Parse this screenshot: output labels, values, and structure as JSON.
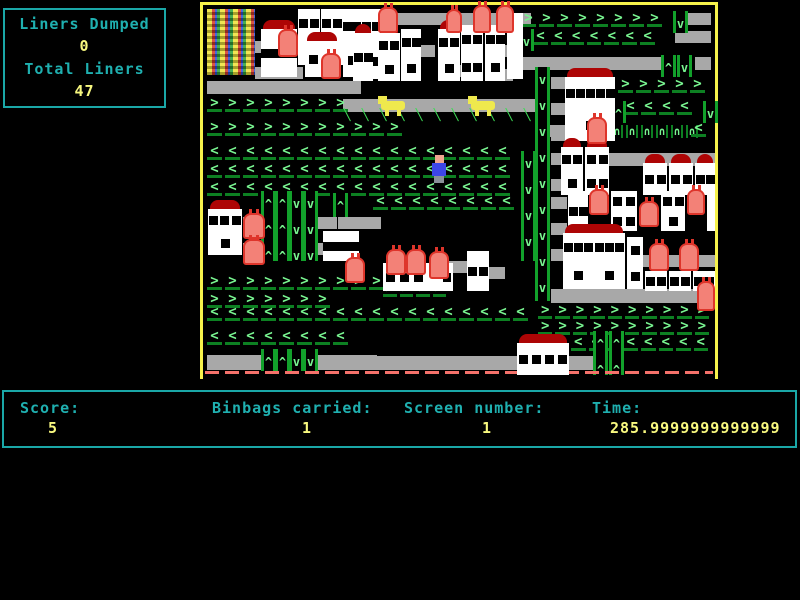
{
  "hud": {
    "liners_dumped_label": "Liners Dumped",
    "liners_dumped_value": "0",
    "total_liners_label": "Total Liners",
    "total_liners_value": "47"
  },
  "status": {
    "score_label": "Score:",
    "score_value": "5",
    "binbags_label": "Binbags carried:",
    "binbags_value": "1",
    "screen_label": "Screen number:",
    "screen_value": "1",
    "time_label": "Time:",
    "time_value": "285.9999999999999"
  },
  "palette": {
    "hud_border": "#1aa7a7",
    "label_teal": "#1fb0b0",
    "value_yellow": "#f8f87f",
    "field_border_yellow": "#f6f24b",
    "arrow_green": "#79f591",
    "bar_green": "#0d8022",
    "road_gray": "#a8a8a8",
    "roof_red": "#ad0505",
    "bin_salmon": "#f38177",
    "player_blue": "#3d46e8",
    "dog_yellow": "#efe94d"
  },
  "game": {
    "sprites": [
      {
        "t": "dump",
        "x": 4,
        "y": 4,
        "w": 48,
        "h": 66
      },
      {
        "t": "road",
        "x": 52,
        "y": 36,
        "w": 52,
        "h": 12
      },
      {
        "t": "road",
        "x": 52,
        "y": 62,
        "w": 48,
        "h": 12
      },
      {
        "t": "road",
        "x": 138,
        "y": 42,
        "w": 30,
        "h": 12
      },
      {
        "t": "road",
        "x": 148,
        "y": 8,
        "w": 180,
        "h": 12
      },
      {
        "t": "road",
        "x": 218,
        "y": 40,
        "w": 14,
        "h": 12
      },
      {
        "t": "road",
        "x": 250,
        "y": 60,
        "w": 14,
        "h": 12
      },
      {
        "t": "road",
        "x": 298,
        "y": 40,
        "w": 12,
        "h": 12
      },
      {
        "t": "road",
        "x": 298,
        "y": 64,
        "w": 12,
        "h": 12
      },
      {
        "t": "road",
        "x": 4,
        "y": 76,
        "w": 154,
        "h": 13
      },
      {
        "t": "road",
        "x": 140,
        "y": 94,
        "w": 200,
        "h": 13
      },
      {
        "t": "road",
        "x": 482,
        "y": 8,
        "w": 26,
        "h": 12
      },
      {
        "t": "road",
        "x": 472,
        "y": 26,
        "w": 36,
        "h": 12
      },
      {
        "t": "road",
        "x": 318,
        "y": 52,
        "w": 140,
        "h": 13
      },
      {
        "t": "road",
        "x": 492,
        "y": 52,
        "w": 16,
        "h": 13
      },
      {
        "t": "road",
        "x": 348,
        "y": 72,
        "w": 14,
        "h": 12
      },
      {
        "t": "road",
        "x": 348,
        "y": 98,
        "w": 14,
        "h": 12
      },
      {
        "t": "road",
        "x": 348,
        "y": 124,
        "w": 14,
        "h": 12
      },
      {
        "t": "road",
        "x": 340,
        "y": 120,
        "w": 44,
        "h": 12
      },
      {
        "t": "road",
        "x": 406,
        "y": 148,
        "w": 106,
        "h": 13
      },
      {
        "t": "road",
        "x": 348,
        "y": 148,
        "w": 12,
        "h": 12
      },
      {
        "t": "road",
        "x": 348,
        "y": 174,
        "w": 12,
        "h": 12
      },
      {
        "t": "road",
        "x": 40,
        "y": 212,
        "w": 18,
        "h": 12
      },
      {
        "t": "road",
        "x": 104,
        "y": 212,
        "w": 30,
        "h": 12
      },
      {
        "t": "road",
        "x": 40,
        "y": 238,
        "w": 18,
        "h": 12
      },
      {
        "t": "road",
        "x": 104,
        "y": 238,
        "w": 30,
        "h": 12
      },
      {
        "t": "road",
        "x": 135,
        "y": 212,
        "w": 43,
        "h": 12
      },
      {
        "t": "road",
        "x": 246,
        "y": 256,
        "w": 18,
        "h": 12
      },
      {
        "t": "road",
        "x": 286,
        "y": 262,
        "w": 16,
        "h": 12
      },
      {
        "t": "road",
        "x": 348,
        "y": 192,
        "w": 16,
        "h": 12
      },
      {
        "t": "road",
        "x": 348,
        "y": 218,
        "w": 16,
        "h": 12
      },
      {
        "t": "road",
        "x": 348,
        "y": 244,
        "w": 16,
        "h": 12
      },
      {
        "t": "road",
        "x": 440,
        "y": 250,
        "w": 72,
        "h": 12
      },
      {
        "t": "road",
        "x": 348,
        "y": 284,
        "w": 160,
        "h": 14
      },
      {
        "t": "road",
        "x": 4,
        "y": 350,
        "w": 170,
        "h": 15
      },
      {
        "t": "road",
        "x": 174,
        "y": 351,
        "w": 140,
        "h": 14
      },
      {
        "t": "road",
        "x": 366,
        "y": 351,
        "w": 24,
        "h": 14
      },
      {
        "t": "chev",
        "dir": "r",
        "x": 318,
        "y": 8,
        "w": 150
      },
      {
        "t": "chev",
        "dir": "l",
        "x": 330,
        "y": 26,
        "w": 125
      },
      {
        "t": "chev",
        "dir": "r",
        "x": 4,
        "y": 93,
        "w": 150
      },
      {
        "t": "diag",
        "x": 136,
        "y": 103,
        "w": 200
      },
      {
        "t": "chev",
        "dir": "r",
        "x": 4,
        "y": 117,
        "w": 200
      },
      {
        "t": "chev",
        "dir": "l",
        "x": 4,
        "y": 141,
        "w": 314
      },
      {
        "t": "chev",
        "dir": "l",
        "x": 4,
        "y": 159,
        "w": 314
      },
      {
        "t": "chev",
        "dir": "l",
        "x": 4,
        "y": 177,
        "w": 314
      },
      {
        "t": "chev",
        "dir": "l",
        "x": 170,
        "y": 191,
        "w": 148
      },
      {
        "t": "chev",
        "dir": "r",
        "x": 415,
        "y": 74,
        "w": 92
      },
      {
        "t": "chev",
        "dir": "l",
        "x": 420,
        "y": 96,
        "w": 80
      },
      {
        "t": "arc",
        "x": 408,
        "y": 120,
        "w": 90
      },
      {
        "t": "chev",
        "dir": "l",
        "x": 488,
        "y": 118,
        "w": 20
      },
      {
        "t": "chev",
        "dir": "r",
        "x": 4,
        "y": 271,
        "w": 200
      },
      {
        "t": "chev",
        "dir": "r",
        "x": 4,
        "y": 289,
        "w": 126
      },
      {
        "t": "chev",
        "dir": "l",
        "x": 4,
        "y": 302,
        "w": 330
      },
      {
        "t": "chev",
        "dir": "r",
        "x": 180,
        "y": 278,
        "w": 66
      },
      {
        "t": "chev",
        "dir": "r",
        "x": 335,
        "y": 300,
        "w": 174
      },
      {
        "t": "chev",
        "dir": "r",
        "x": 335,
        "y": 316,
        "w": 174
      },
      {
        "t": "chev",
        "dir": "l",
        "x": 368,
        "y": 332,
        "w": 140
      },
      {
        "t": "chev",
        "dir": "l",
        "x": 4,
        "y": 326,
        "w": 150
      },
      {
        "t": "vcol",
        "dir": "d",
        "x": 470,
        "y": 6,
        "h": 22
      },
      {
        "t": "vcol",
        "dir": "d",
        "x": 316,
        "y": 24,
        "h": 22
      },
      {
        "t": "vcol",
        "dir": "u",
        "x": 458,
        "y": 50,
        "h": 22
      },
      {
        "t": "vcol",
        "dir": "d",
        "x": 474,
        "y": 50,
        "h": 22
      },
      {
        "t": "vcol",
        "dir": "d",
        "x": 332,
        "y": 62,
        "h": 234
      },
      {
        "t": "vcol",
        "dir": "d",
        "x": 318,
        "y": 146,
        "h": 110
      },
      {
        "t": "vcol",
        "dir": "u",
        "x": 408,
        "y": 96,
        "h": 22
      },
      {
        "t": "vcol",
        "dir": "d",
        "x": 500,
        "y": 96,
        "h": 22
      },
      {
        "t": "vcol",
        "dir": "u",
        "x": 58,
        "y": 186,
        "h": 70
      },
      {
        "t": "vcol",
        "dir": "u",
        "x": 72,
        "y": 186,
        "h": 70
      },
      {
        "t": "vcol",
        "dir": "d",
        "x": 86,
        "y": 186,
        "h": 70
      },
      {
        "t": "vcol",
        "dir": "d",
        "x": 100,
        "y": 186,
        "h": 70
      },
      {
        "t": "vcol",
        "dir": "u",
        "x": 130,
        "y": 188,
        "h": 24
      },
      {
        "t": "vcol",
        "dir": "u",
        "x": 390,
        "y": 326,
        "h": 44
      },
      {
        "t": "vcol",
        "dir": "u",
        "x": 406,
        "y": 326,
        "h": 44
      },
      {
        "t": "vcol",
        "dir": "u",
        "x": 58,
        "y": 344,
        "h": 22
      },
      {
        "t": "vcol",
        "dir": "u",
        "x": 72,
        "y": 344,
        "h": 22
      },
      {
        "t": "vcol",
        "dir": "d",
        "x": 86,
        "y": 344,
        "h": 22
      },
      {
        "t": "vcol",
        "dir": "d",
        "x": 100,
        "y": 344,
        "h": 22
      },
      {
        "t": "redline",
        "x": 2,
        "y": 366,
        "w": 508
      },
      {
        "t": "bldg",
        "x": 58,
        "y": 24,
        "w": 36,
        "h": 48,
        "roof": true,
        "wins": 4
      },
      {
        "t": "bldg",
        "x": 95,
        "y": 4,
        "w": 22,
        "h": 56,
        "roof": false,
        "wins": 3
      },
      {
        "t": "bldg",
        "x": 118,
        "y": 4,
        "w": 22,
        "h": 56,
        "roof": false,
        "wins": 3
      },
      {
        "t": "bldg",
        "x": 102,
        "y": 36,
        "w": 34,
        "h": 36,
        "roof": true,
        "wins": 2
      },
      {
        "t": "bldg",
        "x": 140,
        "y": 4,
        "w": 18,
        "h": 68,
        "roof": false,
        "wins": 3
      },
      {
        "t": "bldg",
        "x": 158,
        "y": 4,
        "w": 20,
        "h": 70,
        "roof": false,
        "wins": 4
      },
      {
        "t": "bldg",
        "x": 150,
        "y": 28,
        "w": 20,
        "h": 48,
        "roof": true,
        "wins": 2
      },
      {
        "t": "bldg",
        "x": 175,
        "y": 28,
        "w": 22,
        "h": 48,
        "roof": true,
        "wins": 3
      },
      {
        "t": "bldg",
        "x": 198,
        "y": 24,
        "w": 20,
        "h": 52,
        "roof": false,
        "wins": 3
      },
      {
        "t": "bldg",
        "x": 235,
        "y": 24,
        "w": 22,
        "h": 52,
        "roof": true,
        "wins": 3
      },
      {
        "t": "bldg",
        "x": 258,
        "y": 20,
        "w": 22,
        "h": 56,
        "roof": false,
        "wins": 4
      },
      {
        "t": "bldg",
        "x": 282,
        "y": 20,
        "w": 20,
        "h": 56,
        "roof": false,
        "wins": 3
      },
      {
        "t": "bldg",
        "x": 304,
        "y": 8,
        "w": 16,
        "h": 66,
        "roof": false,
        "wins": 0
      },
      {
        "t": "bldg",
        "x": 362,
        "y": 72,
        "w": 50,
        "h": 64,
        "roof": true,
        "wins": 6
      },
      {
        "t": "bldg",
        "x": 358,
        "y": 142,
        "w": 22,
        "h": 48,
        "roof": true,
        "wins": 3
      },
      {
        "t": "bldg",
        "x": 382,
        "y": 142,
        "w": 24,
        "h": 48,
        "roof": true,
        "wins": 4
      },
      {
        "t": "bldg",
        "x": 440,
        "y": 158,
        "w": 24,
        "h": 32,
        "roof": true,
        "wins": 2
      },
      {
        "t": "bldg",
        "x": 466,
        "y": 158,
        "w": 24,
        "h": 32,
        "roof": true,
        "wins": 2
      },
      {
        "t": "bldg",
        "x": 492,
        "y": 158,
        "w": 20,
        "h": 32,
        "roof": true,
        "wins": 2
      },
      {
        "t": "bldg",
        "x": 5,
        "y": 204,
        "w": 34,
        "h": 46,
        "roof": true,
        "wins": 4
      },
      {
        "t": "bldg",
        "x": 120,
        "y": 226,
        "w": 36,
        "h": 30,
        "roof": false,
        "wins": 4
      },
      {
        "t": "bldg",
        "x": 180,
        "y": 258,
        "w": 70,
        "h": 28,
        "roof": false,
        "wins": 5
      },
      {
        "t": "bldg",
        "x": 222,
        "y": 258,
        "w": 18,
        "h": 28,
        "roof": false,
        "wins": 0
      },
      {
        "t": "bldg",
        "x": 264,
        "y": 246,
        "w": 22,
        "h": 40,
        "roof": false,
        "wins": 2
      },
      {
        "t": "bldg",
        "x": 365,
        "y": 186,
        "w": 20,
        "h": 40,
        "roof": false,
        "wins": 2
      },
      {
        "t": "bldg",
        "x": 408,
        "y": 186,
        "w": 26,
        "h": 40,
        "roof": false,
        "wins": 4
      },
      {
        "t": "bldg",
        "x": 458,
        "y": 186,
        "w": 24,
        "h": 40,
        "roof": false,
        "wins": 3
      },
      {
        "t": "bldg",
        "x": 504,
        "y": 186,
        "w": 8,
        "h": 40,
        "roof": false,
        "wins": 0
      },
      {
        "t": "bldg",
        "x": 360,
        "y": 228,
        "w": 62,
        "h": 56,
        "roof": true,
        "wins": 8
      },
      {
        "t": "bldg",
        "x": 424,
        "y": 232,
        "w": 16,
        "h": 52,
        "roof": false,
        "wins": 2
      },
      {
        "t": "bldg",
        "x": 442,
        "y": 266,
        "w": 22,
        "h": 20,
        "roof": false,
        "wins": 2
      },
      {
        "t": "bldg",
        "x": 466,
        "y": 266,
        "w": 22,
        "h": 20,
        "roof": false,
        "wins": 2
      },
      {
        "t": "bldg",
        "x": 490,
        "y": 266,
        "w": 22,
        "h": 20,
        "roof": false,
        "wins": 2
      },
      {
        "t": "bldg",
        "x": 314,
        "y": 338,
        "w": 52,
        "h": 32,
        "roof": true,
        "wins": 4
      },
      {
        "t": "bin",
        "x": 118,
        "y": 48,
        "w": 20,
        "h": 26
      },
      {
        "t": "bin",
        "x": 75,
        "y": 24,
        "w": 20,
        "h": 28
      },
      {
        "t": "bin",
        "x": 175,
        "y": 2,
        "w": 20,
        "h": 26
      },
      {
        "t": "bin",
        "x": 243,
        "y": 4,
        "w": 16,
        "h": 24
      },
      {
        "t": "bin",
        "x": 270,
        "y": 0,
        "w": 18,
        "h": 28
      },
      {
        "t": "bin",
        "x": 293,
        "y": 0,
        "w": 18,
        "h": 28
      },
      {
        "t": "bin",
        "x": 384,
        "y": 112,
        "w": 20,
        "h": 27
      },
      {
        "t": "bin",
        "x": 40,
        "y": 208,
        "w": 22,
        "h": 26
      },
      {
        "t": "bin",
        "x": 40,
        "y": 234,
        "w": 22,
        "h": 26
      },
      {
        "t": "bin",
        "x": 142,
        "y": 252,
        "w": 20,
        "h": 26
      },
      {
        "t": "bin",
        "x": 183,
        "y": 244,
        "w": 20,
        "h": 26
      },
      {
        "t": "bin",
        "x": 203,
        "y": 244,
        "w": 20,
        "h": 26
      },
      {
        "t": "bin",
        "x": 226,
        "y": 246,
        "w": 20,
        "h": 28
      },
      {
        "t": "bin",
        "x": 386,
        "y": 184,
        "w": 20,
        "h": 26
      },
      {
        "t": "bin",
        "x": 436,
        "y": 196,
        "w": 20,
        "h": 26
      },
      {
        "t": "bin",
        "x": 484,
        "y": 184,
        "w": 18,
        "h": 26
      },
      {
        "t": "bin",
        "x": 446,
        "y": 238,
        "w": 20,
        "h": 28
      },
      {
        "t": "bin",
        "x": 476,
        "y": 238,
        "w": 20,
        "h": 28
      },
      {
        "t": "bin",
        "x": 494,
        "y": 276,
        "w": 18,
        "h": 30
      },
      {
        "t": "dog",
        "x": 178,
        "y": 90
      },
      {
        "t": "dog",
        "x": 268,
        "y": 90
      },
      {
        "t": "player",
        "x": 228,
        "y": 150
      }
    ]
  }
}
